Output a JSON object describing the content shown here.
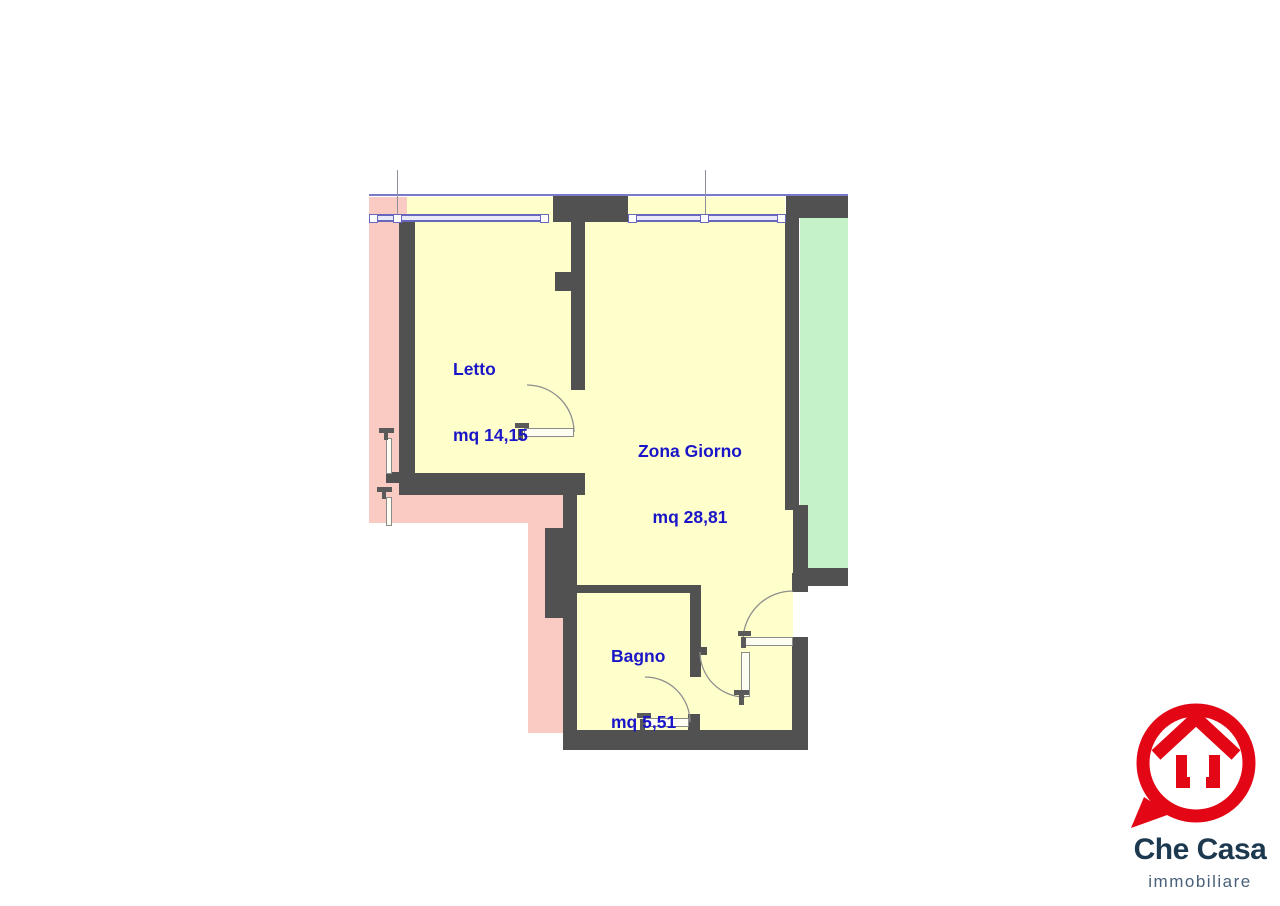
{
  "plan": {
    "type": "apartment-floor-plan",
    "rooms": [
      {
        "name": "Letto",
        "area": "mq 14,15"
      },
      {
        "name": "Zona Giorno",
        "area": "mq 28,81"
      },
      {
        "name": "Bagno",
        "area": "mq 5,51"
      }
    ]
  },
  "logo": {
    "brand": "Che Casa",
    "tagline": "immobiliare"
  },
  "colors": {
    "wall": "#515151",
    "interior_floor": "#ffffcc",
    "exterior_area": "#f9cbc3",
    "balcony": "#c5f2c6",
    "room_label": "#1a16c8",
    "window_frame": "#6767bd",
    "logo_red": "#e30615",
    "logo_navy": "#1d3950",
    "logo_slate": "#49607a"
  }
}
